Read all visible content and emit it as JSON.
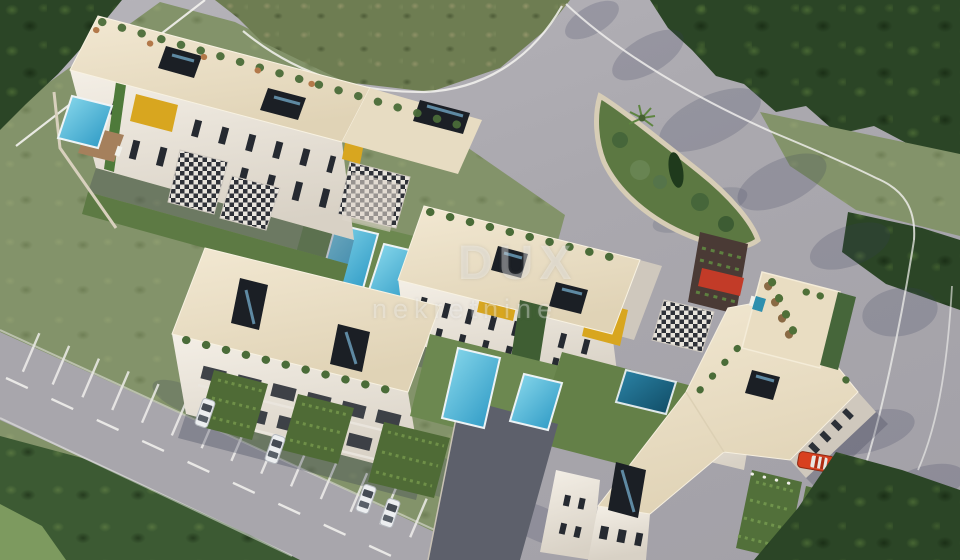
{
  "scene": {
    "description": "Aerial 3D architectural rendering of a white residential apartment complex with rooftop terraces, skylights, yellow facade accent panels, private swimming pools, landscaped gardens, pergola-covered parking with cars, and surrounding asphalt roads bordered by dense trees and scrubland",
    "watermark": {
      "brand": "DUX",
      "subtitle": "nekretnine"
    },
    "palette": {
      "asphalt": "#a9a7ae",
      "grass": "#84946a",
      "scrub_field": "#6e7d52",
      "trees_dark": "#2c4627",
      "roof_cream": "#ece1c9",
      "wall_white": "#f1ece2",
      "window_dark": "#262a31",
      "accent_yellow": "#d8a61f",
      "pergola_red": "#c23b28",
      "pool_light": "#49b4d9",
      "pool_dark": "#155f80",
      "car_red": "#d8401f",
      "car_white": "#eceef0",
      "deck_wood": "#a5805c",
      "stone_wall": "#d7cdb6",
      "vine_green": "#52703a",
      "road_marking": "#f4f3f0"
    }
  }
}
